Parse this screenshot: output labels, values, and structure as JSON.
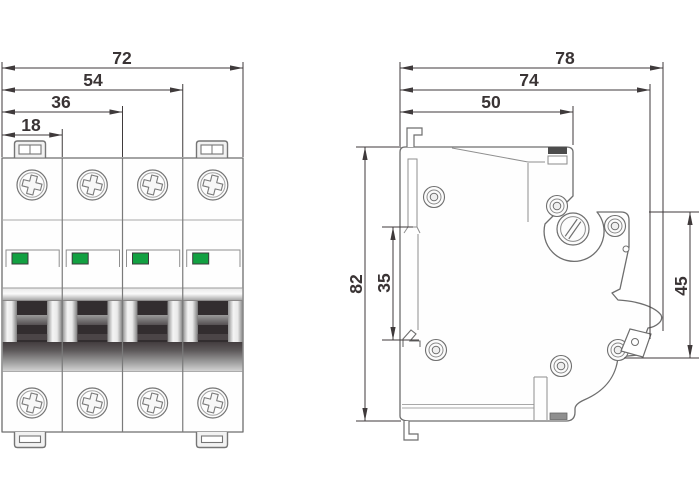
{
  "drawing": {
    "type": "technical-dimension-drawing",
    "subject": "4-pole miniature circuit breaker, front and side elevation with millimetre dimensions",
    "views": {
      "front": {
        "pole_count": 4,
        "dims": [
          {
            "label": "72"
          },
          {
            "label": "54"
          },
          {
            "label": "36"
          },
          {
            "label": "18"
          }
        ]
      },
      "side": {
        "width_dims": [
          {
            "label": "78"
          },
          {
            "label": "74"
          },
          {
            "label": "50"
          }
        ],
        "height_dims": [
          {
            "label": "82"
          },
          {
            "label": "35"
          },
          {
            "label": "45"
          }
        ]
      }
    },
    "colors": {
      "indicator_green": "#12A041",
      "dimension_line": "#3F3A3B",
      "outline_gray": "#6E6E6E"
    }
  }
}
